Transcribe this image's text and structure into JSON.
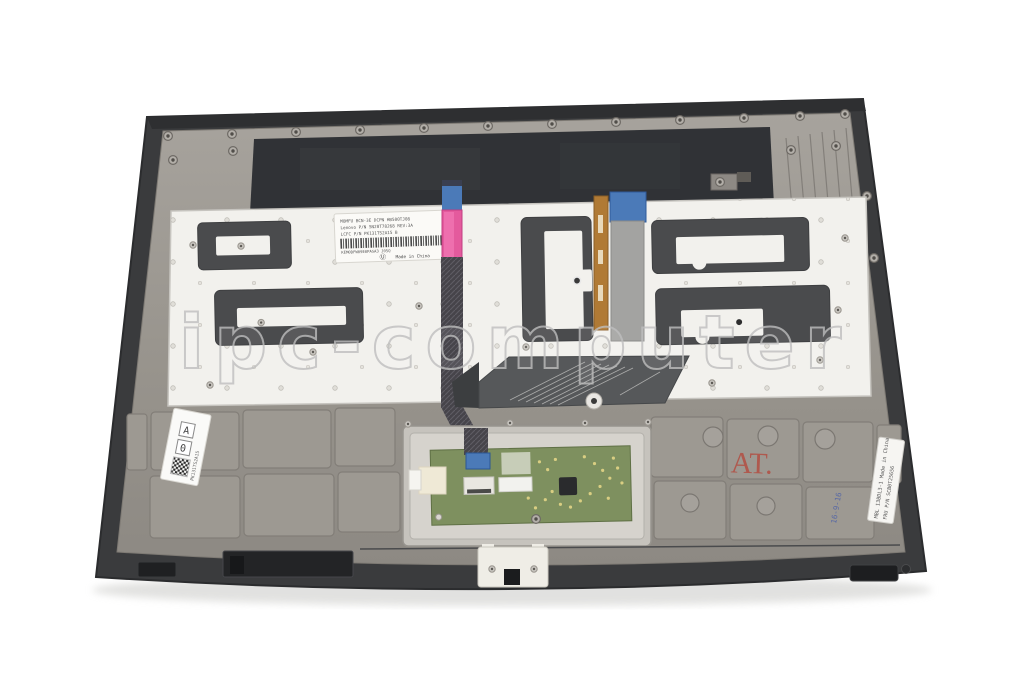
{
  "photo": {
    "watermark_text": "ipc-computer",
    "palmrest_stamp": "AT.",
    "date_stamp": "16-9-16",
    "keyboard_label": {
      "line1": "MOMFU BCN-3E   DCPN HB500TJ08",
      "line2": "Lenovo P/N SN20T78268   REV:3A",
      "line3": "LCFC P/N PK131TS2A15 B",
      "barcode_text": "KEM0DFW09E0PASA3 J05Q",
      "cert_mark": "Ⓤ",
      "origin": "Made in China"
    },
    "left_label": {
      "box_top": "A",
      "box_bottom": "0",
      "side_code": "PK131TS2A15"
    },
    "right_label": {
      "line1": "MBL 13BDL3-1  Made in China",
      "line2": "FRU P/N SCB0T25656"
    },
    "colors": {
      "case_dark": "#3a3b3d",
      "magnesium": "#9a968f",
      "keyboard_plate": "#f2f1ed",
      "adhesive_foil": "#4a4b4d",
      "cable_pink": "#e45a9d",
      "stiffener_blue": "#4b7ab8",
      "backlight_copper": "#b07a35",
      "touchpad_pcb_green": "#7e905f",
      "stamp_red": "#b44a3e"
    }
  }
}
